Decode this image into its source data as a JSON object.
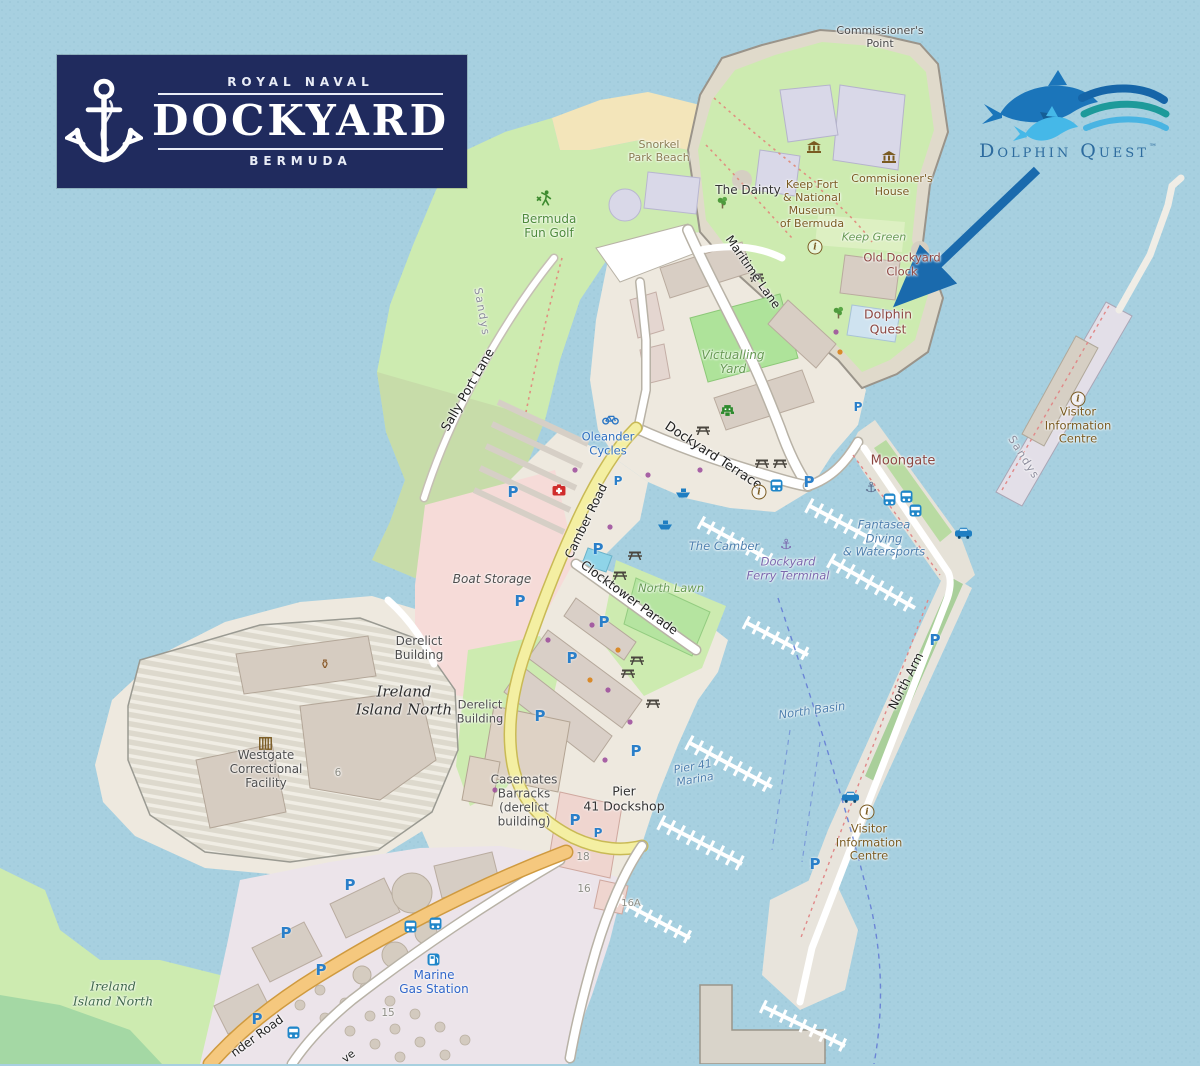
{
  "title": "Royal Naval Dockyard Bermuda map with Dolphin Quest location",
  "branding": {
    "dockyard_logo": {
      "line_top": "ROYAL NAVAL",
      "title": "DOCKYARD",
      "line_bottom": "BERMUDA"
    },
    "dolphin_quest_logo": {
      "name": "Dolphin Quest",
      "trademark": "™"
    }
  },
  "map": {
    "labels": {
      "commissioners_point": "Commissioner's\nPoint",
      "snorkel_park_beach": "Snorkel\nPark Beach",
      "the_dainty": "The Dainty",
      "keep_fort_museum": "Keep Fort\n& National\nMuseum\nof Bermuda",
      "commissioners_house": "Commisioner's\nHouse",
      "keep_green": "Keep Green",
      "old_dockyard_clock": "Old Dockyard\nClock",
      "dolphin_quest": "Dolphin\nQuest",
      "bermuda_fun_golf": "Bermuda\nFun Golf",
      "maritime_lane": "Maritime Lane",
      "sandys_west": "Sandys",
      "sandys_east": "Sandys",
      "sally_port_lane": "Sally Port Lane",
      "victualling_yard": "Victualling\nYard",
      "dockyard_terrace": "Dockyard Terrace",
      "oleander_cycles": "Oleander\nCycles",
      "moongate": "Moongate",
      "visitor_information_centre_north": "Visitor\nInformation\nCentre",
      "camber_road": "Camber Road",
      "the_camber": "The Camber",
      "dockyard_ferry_terminal": "Dockyard\nFerry Terminal",
      "fantasea_diving": "Fantasea\nDiving\n& Watersports",
      "boat_storage": "Boat Storage",
      "clocktower_parade": "Clocktower Parade",
      "north_lawn": "North Lawn",
      "derelict_building_1": "Derelict\nBuilding",
      "derelict_building_2": "Derelict\nBuilding",
      "ireland_island_north_central": "Ireland\nIsland North",
      "westgate_correctional_facility": "Westgate\nCorrectional\nFacility",
      "north_basin": "North Basin",
      "north_arm": "North Arm",
      "pier_41_marina": "Pier 41\nMarina",
      "casemates_barracks": "Casemates\nBarracks\n(derelict\nbuilding)",
      "pier_41_dockshop": "Pier\n41 Dockshop",
      "visitor_information_centre_south": "Visitor\nInformation\nCentre",
      "marine_gas_station": "Marine\nGas Station",
      "ireland_island_north_southwest": "Ireland\nIsland North",
      "pender_road_partial": "nder Road",
      "avenue_partial": "ve",
      "building_no_6": "6",
      "building_no_15": "15",
      "building_no_16": "16",
      "building_no_16a": "16A",
      "building_no_18": "18"
    },
    "icons": {
      "parking_glyph": "P",
      "info_glyph": "i",
      "anchor_glyph": "⚓",
      "amphora_glyph": "⚱"
    },
    "colors": {
      "water": "#a7d0e0",
      "park_green": "#cdebb0",
      "sand": "#f3e5ba",
      "road_yellow": "#f4efa2",
      "road_orange": "#f5c87e",
      "arrow_blue": "#1a6aad",
      "logo_navy": "#202b5e",
      "dolphin_blue": "#2d6b9e"
    }
  }
}
